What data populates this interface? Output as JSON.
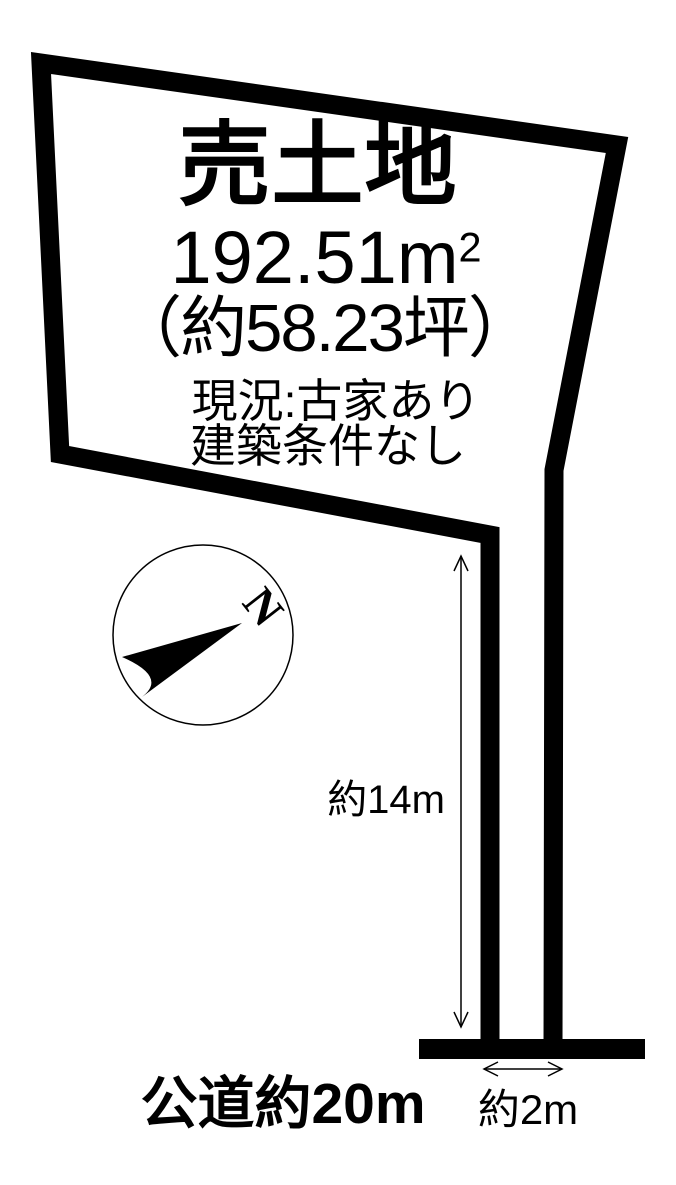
{
  "diagram": {
    "title": "売土地",
    "area": {
      "value": "192.51",
      "unit_base": "m",
      "unit_sup": "2"
    },
    "area_tsubo": "（約58.23坪）",
    "status_line1": "現況:古家あり",
    "status_line2": "建築条件なし",
    "compass_label": "N",
    "dimension_depth": "約14m",
    "dimension_width": "約2m",
    "road_label": "公道約20m",
    "colors": {
      "line": "#000000",
      "background": "#ffffff"
    }
  }
}
